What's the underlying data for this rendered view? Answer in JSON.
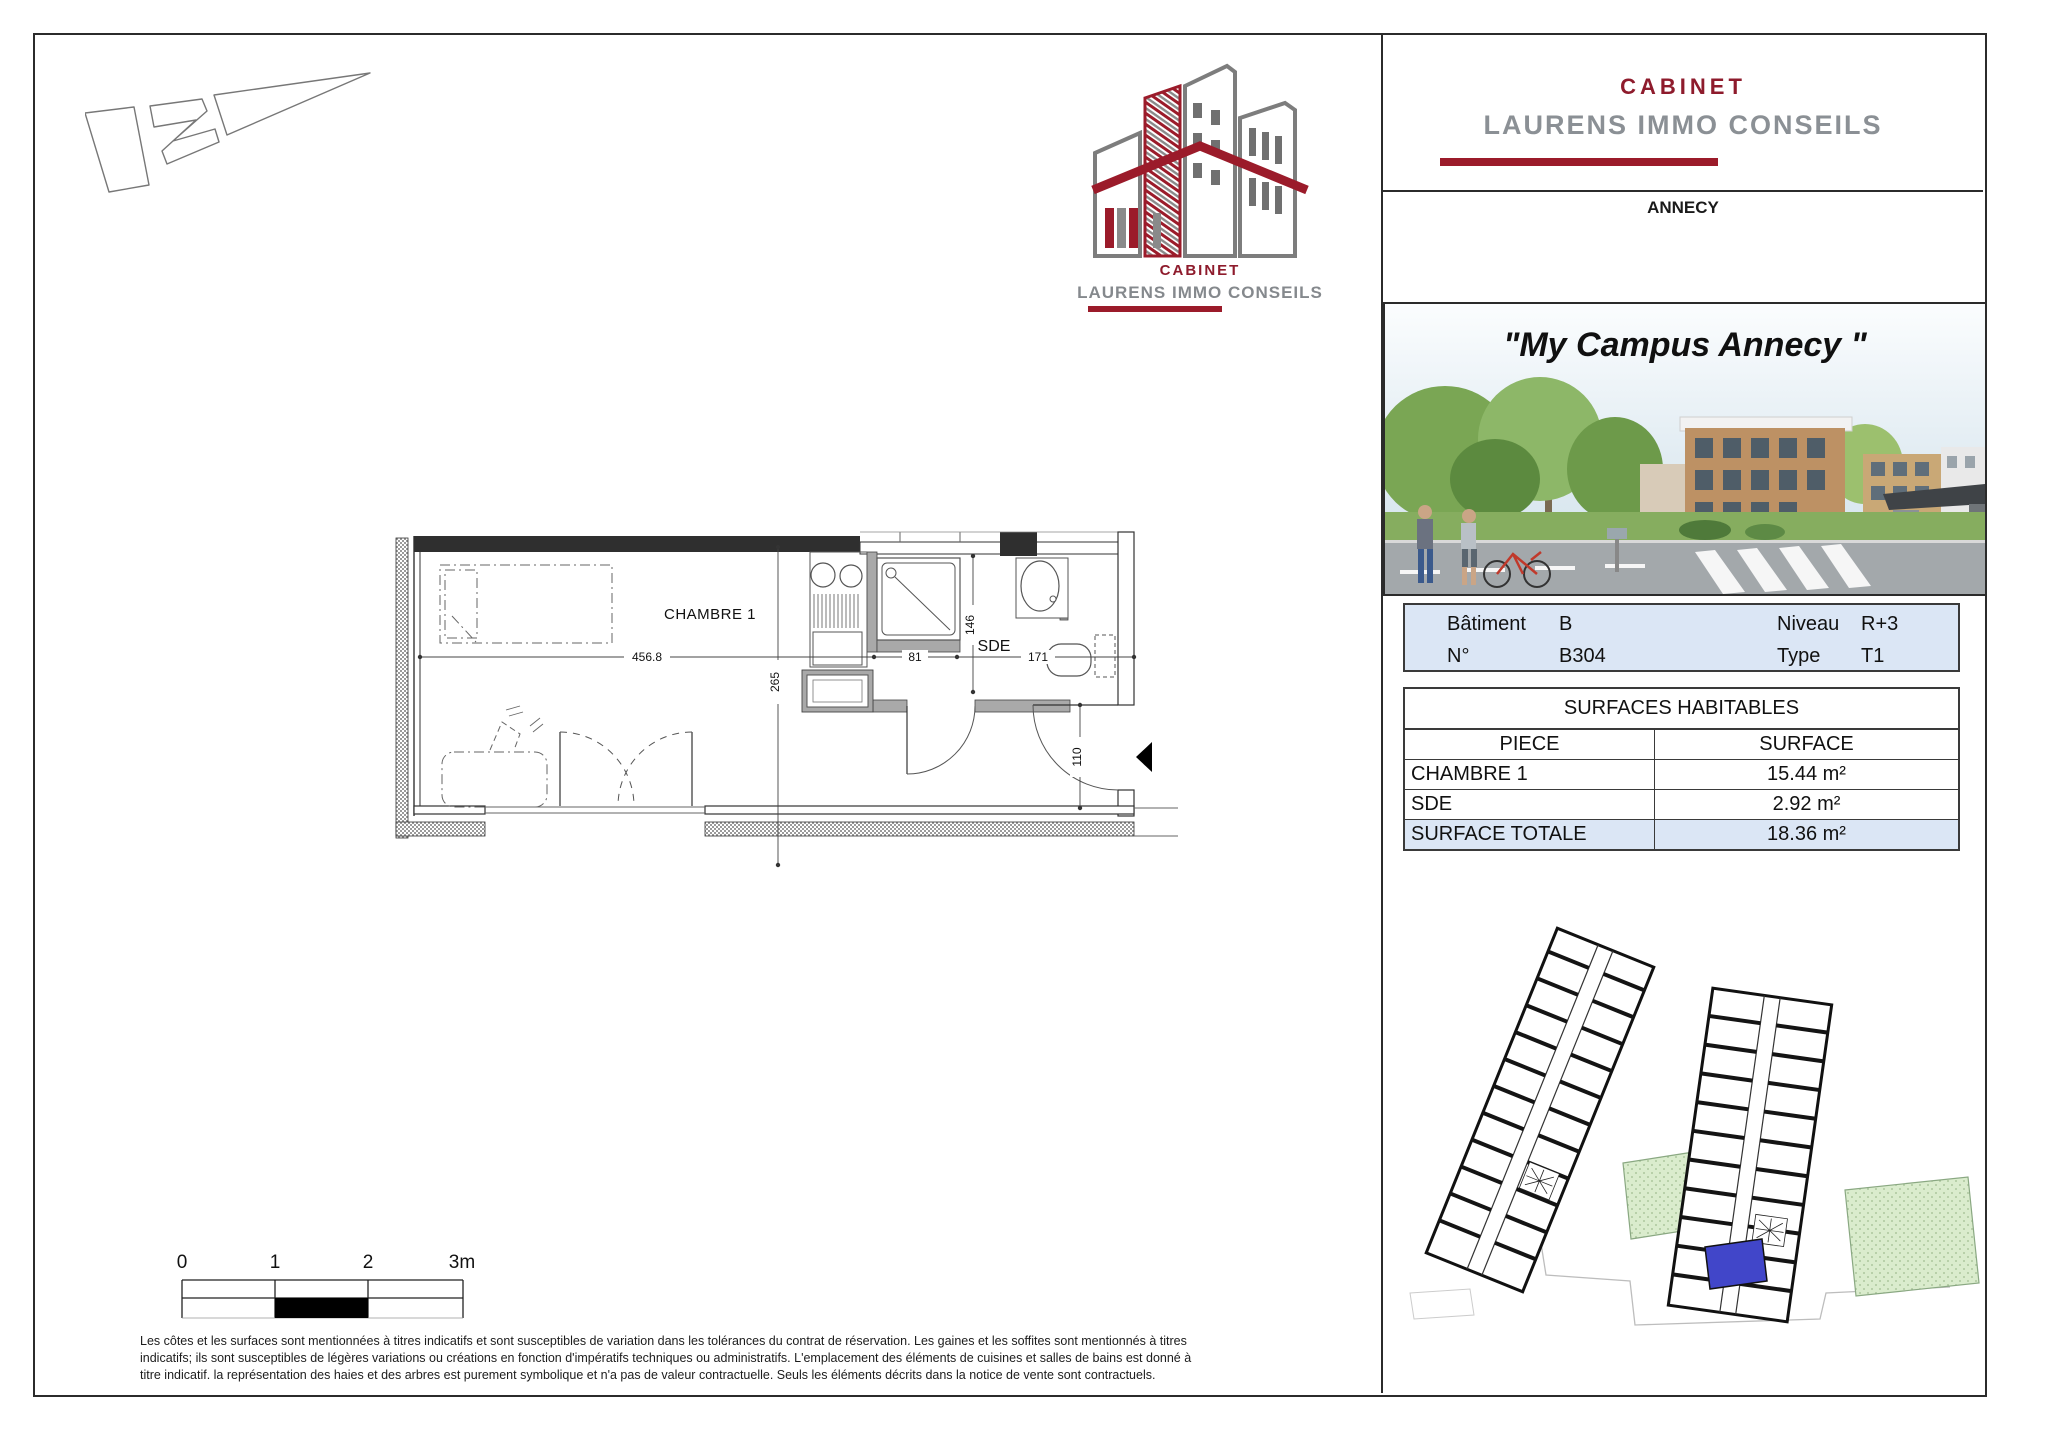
{
  "logo": {
    "cabinet": "CABINET",
    "name": "LAURENS IMMO CONSEILS"
  },
  "right_panel": {
    "header": {
      "cabinet": "CABINET",
      "name": "LAURENS IMMO CONSEILS",
      "city": "ANNECY"
    },
    "photo_title": "\"My Campus Annecy \"",
    "info": {
      "r1c1_label": "Bâtiment",
      "r1c1_value": "B",
      "r1c2_label": "Niveau",
      "r1c2_value": "R+3",
      "r2c1_label": "N°",
      "r2c1_value": "B304",
      "r2c2_label": "Type",
      "r2c2_value": "T1"
    },
    "surfaces": {
      "title": "SURFACES HABITABLES",
      "col_piece": "PIECE",
      "col_surface": "SURFACE",
      "rows": [
        {
          "piece": "CHAMBRE 1",
          "surface": "15.44 m²"
        },
        {
          "piece": "SDE",
          "surface": "2.92 m²"
        }
      ],
      "total": {
        "piece": "SURFACE TOTALE",
        "surface": "18.36 m²"
      }
    }
  },
  "floor_plan": {
    "room_chambre": "CHAMBRE 1",
    "room_sde": "SDE",
    "dim_width": "456.8",
    "dim_height": "265",
    "dim_kitchen": "81",
    "dim_shower": "146",
    "dim_sde": "171",
    "dim_door": "110"
  },
  "scale_bar": {
    "t0": "0",
    "t1": "1",
    "t2": "2",
    "t3": "3m"
  },
  "disclaimer": {
    "line1": "Les côtes et les surfaces sont mentionnées à titres indicatifs et sont susceptibles de variation dans les tolérances du contrat de réservation. Les gaines et les soffites sont mentionnés à titres",
    "line2": "indicatifs; ils sont susceptibles de légères variations ou créations en fonction d'impératifs techniques ou administratifs. L'emplacement des éléments de cuisines et salles de bains est donné à",
    "line3": "titre indicatif. la représentation des haies et des arbres est purement symbolique et n'a pas de valeur contractuelle. Seuls les éléments décrits dans la notice de vente sont contractuels."
  },
  "colors": {
    "accent_red": "#9b1b2a",
    "logo_gray": "#8b9095",
    "table_blue": "#dbe6f5",
    "plan_green": "#daeccd",
    "unit_blue": "#4146c9"
  }
}
